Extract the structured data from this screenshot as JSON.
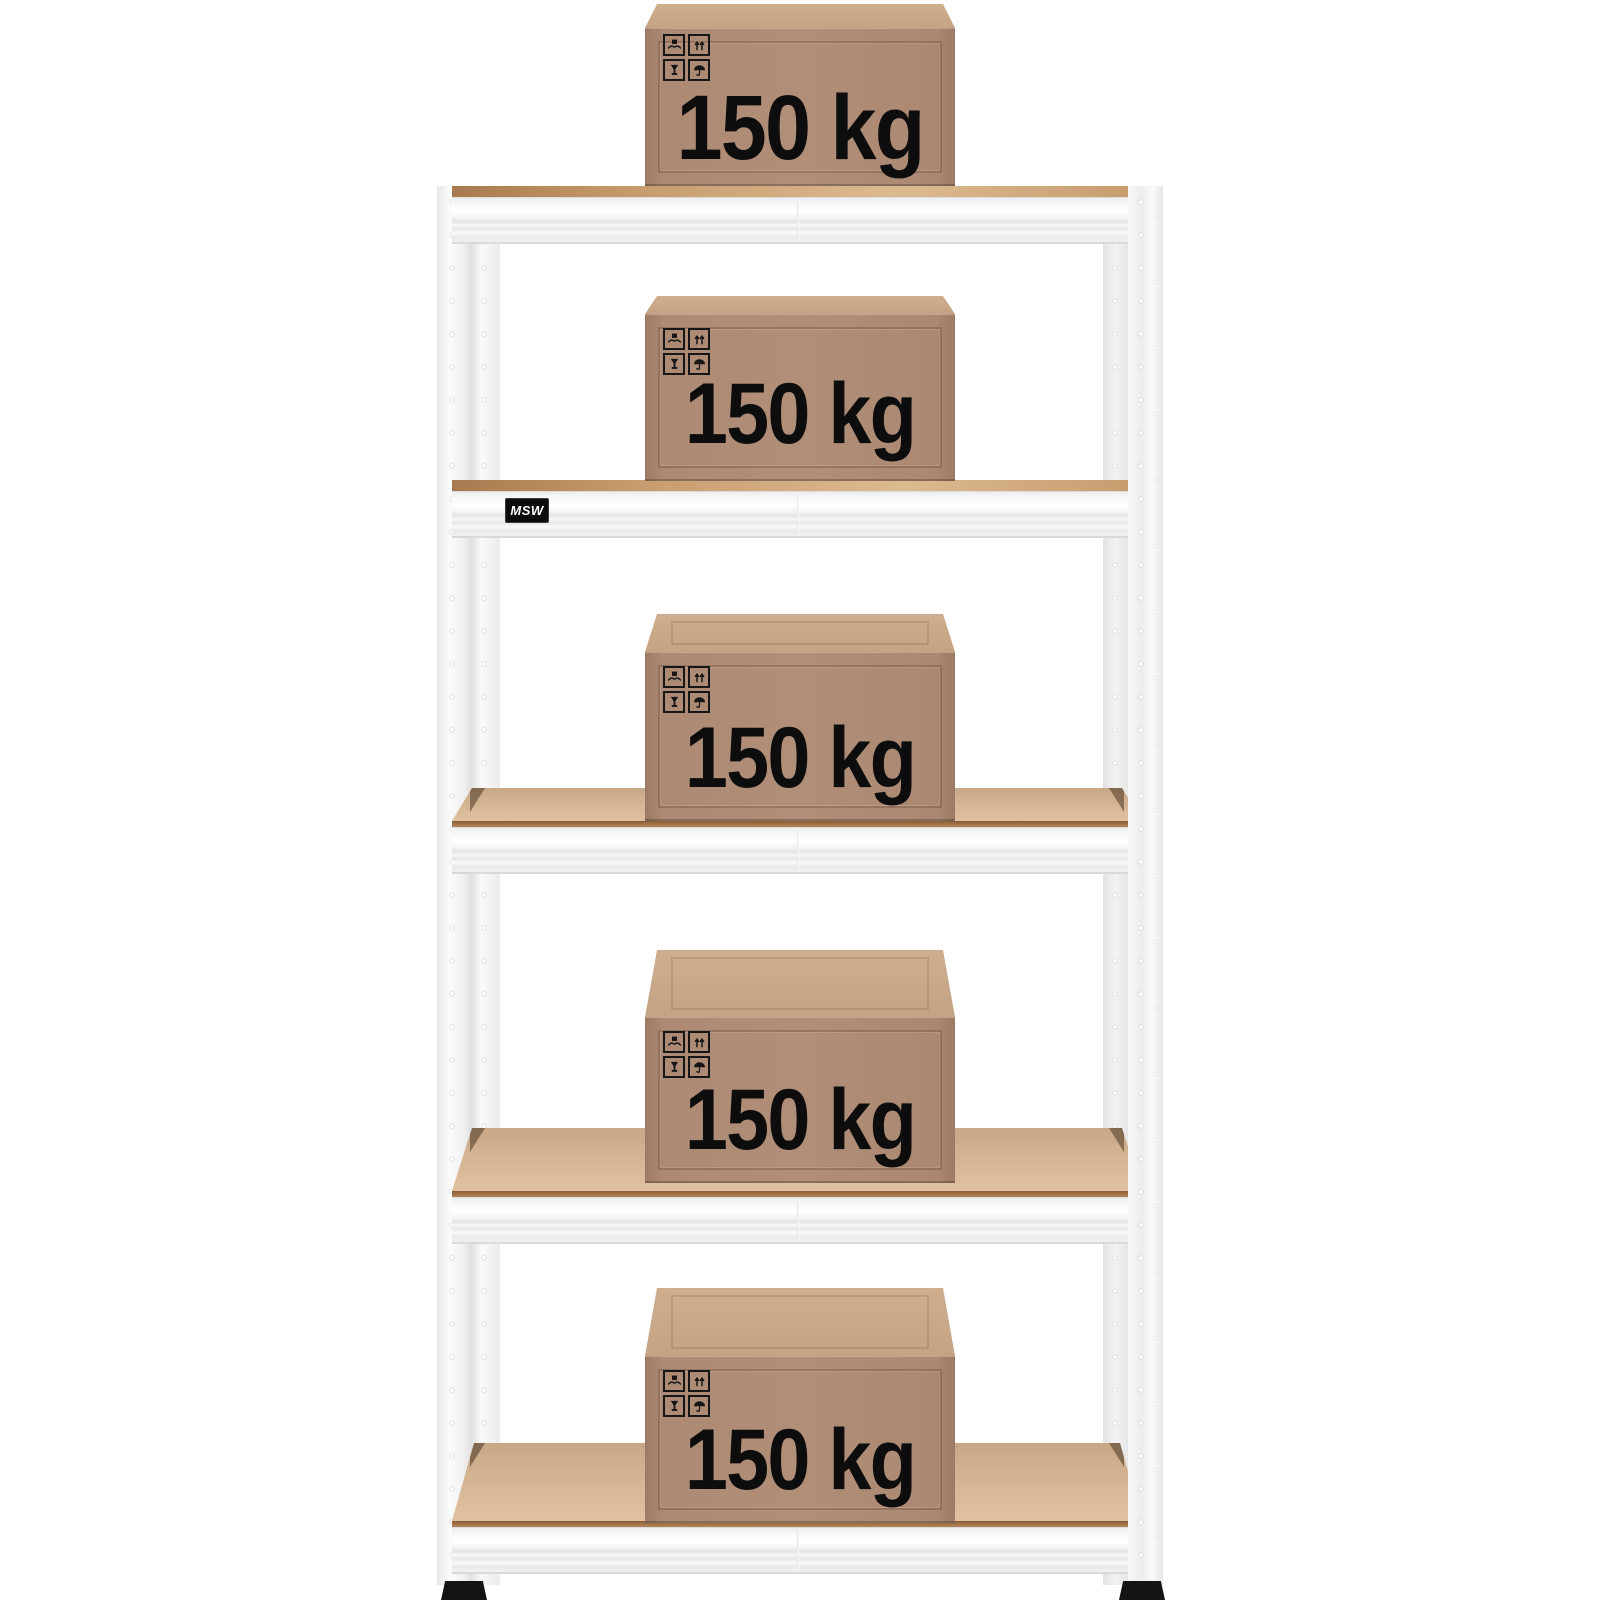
{
  "scene": {
    "description": "Product photo: five-tier white storage rack loaded with cardboard boxes",
    "shelf_count": 5
  },
  "rack": {
    "brand_label": "MSW"
  },
  "boxes": [
    {
      "label": "150 kg"
    },
    {
      "label": "150 kg"
    },
    {
      "label": "150 kg"
    },
    {
      "label": "150 kg"
    },
    {
      "label": "150 kg"
    }
  ],
  "pictograms": [
    "handle-with-care",
    "this-way-up",
    "fragile",
    "keep-dry"
  ],
  "colors": {
    "page_bg": "#ffffff",
    "frame": "#f2f2f2",
    "board_surface": "#d5b695",
    "board_edge": "#b98a5e",
    "box_front": "#ab8872",
    "box_top": "#c4a385",
    "pictogram": "#161616",
    "weight_text": "#0d0d0d",
    "feet": "#141414",
    "label_bg": "#0c0c0c",
    "label_text": "#ffffff"
  }
}
